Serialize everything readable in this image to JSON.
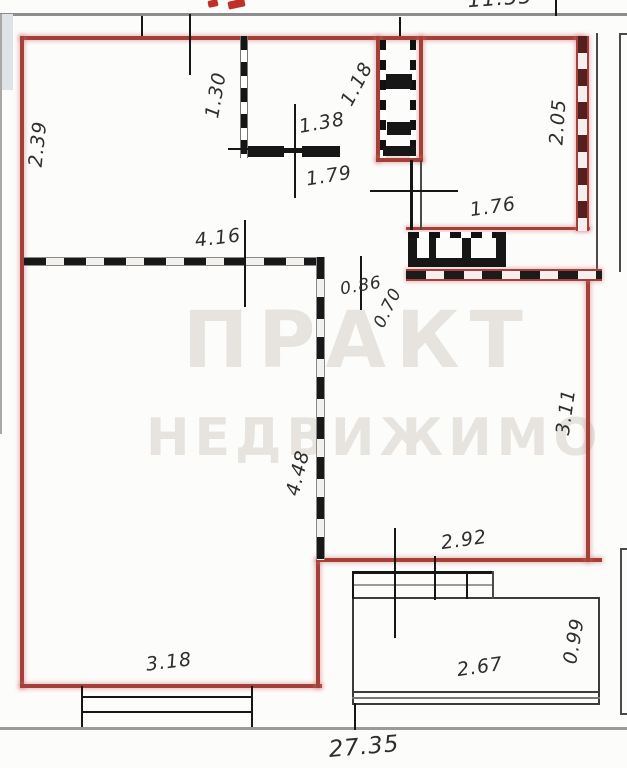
{
  "plan": {
    "type": "apartment-floor-plan",
    "description": "Scanned apartment floor plan, unit outlined in red with dashed partitions, vent shafts and balcony"
  },
  "labels": [
    {
      "text": "2.39"
    },
    {
      "text": "1.30"
    },
    {
      "text": "1.38"
    },
    {
      "text": "1.18"
    },
    {
      "text": "1.79"
    },
    {
      "text": "2.05"
    },
    {
      "text": "4.16"
    },
    {
      "text": "1.76"
    },
    {
      "text": "0.86"
    },
    {
      "text": "0.70"
    },
    {
      "text": "3.11"
    },
    {
      "text": "4.48"
    },
    {
      "text": "2.92"
    },
    {
      "text": "3.18"
    },
    {
      "text": "2.67"
    },
    {
      "text": "0.99"
    },
    {
      "text": "27.35"
    },
    {
      "text": "11.55"
    }
  ],
  "watermark": {
    "line1": "ПРАКТ",
    "line2": "НЕДВИЖИМО"
  },
  "colors": {
    "wall_red": "#a34039",
    "wall_black": "#1a1a1a",
    "slab_gray": "#8d8d8d",
    "dimension_text": "#2e2e2e",
    "watermark_gray": "#e7e4df",
    "clipped_red_text": "#c03028"
  }
}
